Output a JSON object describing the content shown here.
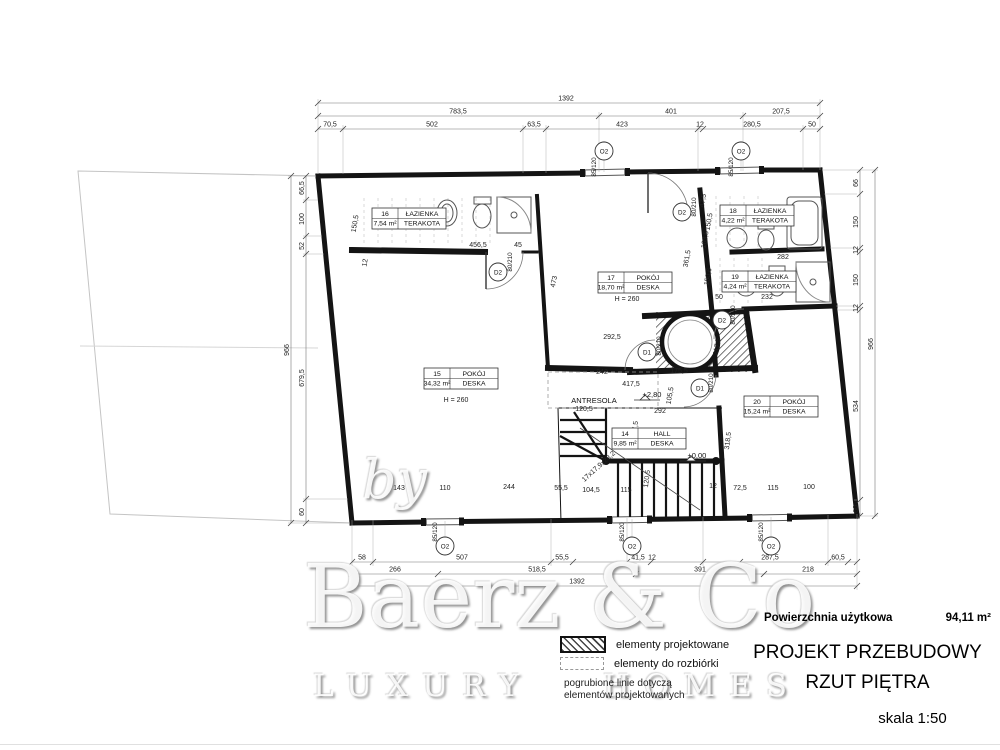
{
  "title_block": {
    "area_label": "Powierzchnia użytkowa",
    "area_value": "94,11 m²",
    "title_line1": "PROJEKT PRZEBUDOWY",
    "title_line2": "RZUT PIĘTRA",
    "scale": "skala 1:50"
  },
  "legend": {
    "item_projected": "elementy projektowane",
    "item_demolition": "elementy do rozbiórki",
    "note_line1": "pogrubione linie dotyczą",
    "note_line2": "elementów projektowanych"
  },
  "watermark": {
    "by": "by",
    "name": "Baerz & Co",
    "tagline": "LUXURY HOMES"
  },
  "rooms": [
    {
      "no": "16",
      "name": "ŁAZIENKA",
      "area": "7,54 m²",
      "floor": "TERAKOTA"
    },
    {
      "no": "17",
      "name": "POKÓJ",
      "area": "18,70 m²",
      "floor": "DESKA"
    },
    {
      "no": "18",
      "name": "ŁAZIENKA",
      "area": "4,22 m²",
      "floor": "TERAKOTA"
    },
    {
      "no": "19",
      "name": "ŁAZIENKA",
      "area": "4,24 m²",
      "floor": "TERAKOTA"
    },
    {
      "no": "15",
      "name": "POKÓJ",
      "area": "34,32 m²",
      "floor": "DESKA"
    },
    {
      "no": "14",
      "name": "HALL",
      "area": "9,85 m²",
      "floor": "DESKA"
    },
    {
      "no": "20",
      "name": "POKÓJ",
      "area": "15,24 m²",
      "floor": "DESKA"
    }
  ],
  "notes": {
    "height": "H = 260",
    "antresola": "ANTRESOLA",
    "level_upper": "+2,80",
    "level_zero": "±0,00",
    "stairs": "17x17,9x28,2"
  },
  "markers": {
    "window_label": "O2",
    "door1_label": "D1",
    "door2_label": "D2",
    "window_size": "85/120",
    "door_size": "80/210"
  },
  "dims": {
    "top_row1": "1392",
    "top_row2": [
      "783,5",
      "401",
      "207,5"
    ],
    "top_row3": [
      "70,5",
      "502",
      "63,5",
      "423",
      "12",
      "280,5",
      "50"
    ],
    "bottom_row1": [
      "58",
      "507",
      "55,5",
      "41,5",
      "12",
      "287,5",
      "60,5"
    ],
    "bottom_row2": [
      "266",
      "518,5",
      "391",
      "218"
    ],
    "bottom_row3": "1392",
    "left_col": [
      "66,5",
      "100",
      "52",
      "679,5",
      "60"
    ],
    "left_total": "966",
    "right_col": [
      "66",
      "150",
      "12",
      "150",
      "12",
      "534",
      "60"
    ],
    "right_total": "966",
    "interior": {
      "d456_5": "456,5",
      "d45": "45",
      "d150_5a": "150,5",
      "d473": "473",
      "d292_5": "292,5",
      "d242": "242",
      "d417_5": "417,5",
      "d175_5": "175,5",
      "d105_5": "105,5",
      "d217_5": "217,5",
      "d47_5": "47,5",
      "d150_5b": "150,5",
      "d103_5": "103,5",
      "d361_5": "361,5",
      "d150_6": "150,6",
      "d50a": "50",
      "d282": "282",
      "d232": "232",
      "d292": "292",
      "d120_5a": "120,5",
      "d137_5": "137,5",
      "d318_5": "318,5",
      "d12a": "12",
      "d12b": "12",
      "d72_5": "72,5",
      "d115a": "115",
      "d100": "100",
      "d143": "143",
      "d110": "110",
      "d244": "244",
      "d55_5": "55,5",
      "d104_5": "104,5",
      "d115b": "115",
      "d120_5b": "120,5"
    }
  }
}
